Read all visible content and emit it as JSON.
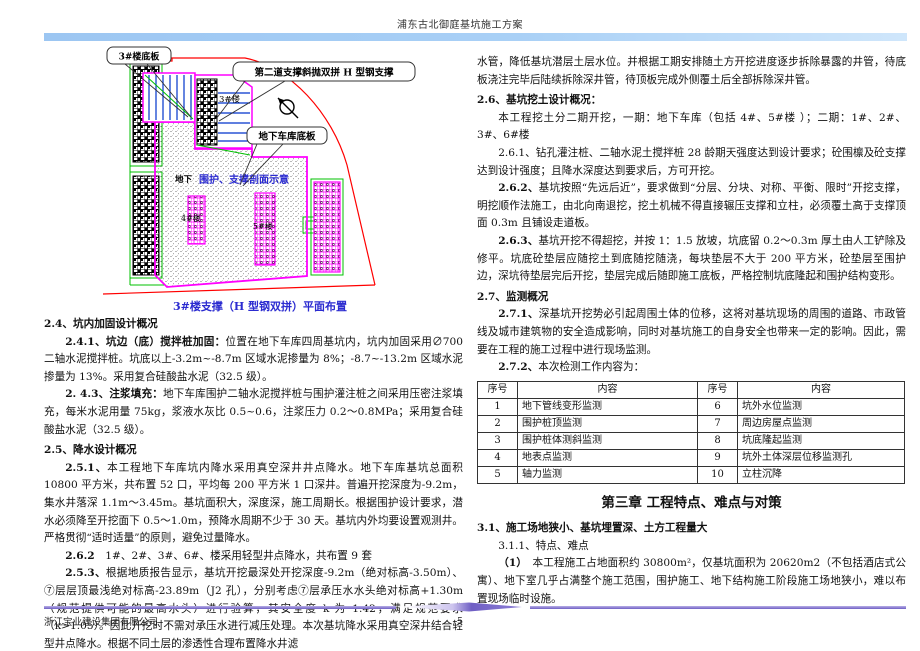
{
  "header": {
    "title": "浦东古北御庭基坑施工方案"
  },
  "diagram": {
    "callout_slab3": "3#楼底板",
    "callout_brace": "第二道支撑斜抛双拼 H 型钢支撑",
    "callout_garage": "地下车库底板",
    "label_underground": "地下",
    "label_section_sketch": "围护、支撑剖面示意",
    "label_bldg3": "3#楼",
    "label_bldg4": "4#楼",
    "label_bldg5": "5#楼",
    "caption": "3#楼支撑（H 型钢双拼）平面布置",
    "colors": {
      "boundary_red": "#ff0000",
      "pit_magenta": "#ff00ff",
      "site_green": "#00c000",
      "brace_blue": "#0033cc",
      "caption_blue": "#2b2bd0"
    }
  },
  "left": {
    "s24_title": "2.4、坑内加固设计概况",
    "s241_label": "2.4.1、坑边（底）搅拌桩加固：",
    "s241_text": "位置在地下车库四周基坑内，坑内加固采用∅700 二轴水泥搅拌桩。坑底以上-3.2m~-8.7m 区域水泥掺量为 8%；-8.7~-13.2m 区域水泥掺量为 13%。采用复合硅酸盐水泥（32.5 级）。",
    "s243_label": "2. 4.3、注浆填充：",
    "s243_text": "地下车库围护二轴水泥搅拌桩与围护灌注桩之间采用压密注浆填充，每米水泥用量 75kg，浆液水灰比 0.5~0.6，注浆压力 0.2～0.8MPa；采用复合硅酸盐水泥（32.5 级）。",
    "s25_title": "2.5、降水设计概况",
    "s251_label": "2.5.1、",
    "s251_text": "本工程地下车库坑内降水采用真空深井井点降水。地下车库基坑总面积 10800 平方米，共布置 52 口，平均每 200 平方米 1 口深井。普遍开挖深度为-9.2m，集水井落深 1.1m～3.45m。基坑面积大，深度深，施工周期长。根据围护设计要求，潜水必须降至开挖面下 0.5～1.0m，预降水周期不少于 30 天。基坑内外均要设置观测井。严格贯彻“适时适量”的原则，避免过量降水。",
    "s262_label": "2.6.2",
    "s262_text": "　1#、2#、3#、6#、楼采用轻型井点降水，共布置 9 套",
    "s253_label": "2.5.3、",
    "s253_text": "根据地质报告显示，基坑开挖最深处开挖深度-9.2m（绝对标高-3.50m）、⑦层层顶最浅绝对标高-23.89m（J2 孔），分别考虑⑦层承压水水头绝对标高+1.30m（规范提供可能的最高水头）进行验算，其安全度 k 为 1.42，满足规范要求（k>1.05）。因此开挖时不需对承压水进行减压处理。本次基坑降水采用真空深井结合轻型井点降水。根据不同土层的渗透性合理布置降水井滤"
  },
  "right": {
    "cont_text": "水管，降低基坑潜层土层水位。并根据工期安排随土方开挖进度逐步拆除暴露的井管，待底板浇注完毕后陆续拆除深井管，待顶板完成外侧覆土后全部拆除深井管。",
    "s26_title": "2.6、基坑挖土设计概况：",
    "s26_intro": "本工程挖土分二期开挖，一期：地下车库（包括 4#、5#楼 ）；二期：1#、2#、3#、6#楼",
    "s261_label": "2.6.1、",
    "s261_text": "钻孔灌注桩、二轴水泥土搅拌桩 28 龄期天强度达到设计要求；砼围檩及砼支撑达到设计强度；且降水深度达到要求后，方可开挖。",
    "s262_label": "2.6.2、",
    "s262_text": "基坑按照“先远后近”，要求做到“分层、分块、对称、平衡、限时”开挖支撑，明挖顺作法施工，由北向南退挖，挖土机械不得直接辗压支撑和立柱，必须覆土高于支撑顶面 0.3m 且铺设走道板。",
    "s263_label": "2.6.3、",
    "s263_text": "基坑开挖不得超挖，并按 1：1.5 放坡，坑底留 0.2～0.3m 厚土由人工铲除及修平。坑底砼垫层应随挖土到底随挖随浇，每块垫层不大于 200 平方米，砼垫层至围护边，深坑待垫层完后开挖，垫层完成后随即施工底板，严格控制坑底隆起和围护结构变形。",
    "s27_title": "2.7、监测概况",
    "s271_label": "2.7.1、",
    "s271_text": "深基坑开挖势必引起周围土体的位移，这将对基坑现场的周围的道路、市政管线及城市建筑物的安全造成影响，同时对基坑施工的自身安全也带来一定的影响。因此，需要在工程的施工过程中进行现场监测。",
    "s272_label": "2.7.2、",
    "s272_text": "本次检测工作内容为：",
    "table": {
      "headers": [
        "序号",
        "内容",
        "序号",
        "内容"
      ],
      "rows": [
        [
          "1",
          "地下管线变形监测",
          "6",
          "坑外水位监测"
        ],
        [
          "2",
          "围护桩顶监测",
          "7",
          "周边房屋点监测"
        ],
        [
          "3",
          "围护桩体测斜监测",
          "8",
          "坑底隆起监测"
        ],
        [
          "4",
          "地表点监测",
          "9",
          "坑外土体深层位移监测孔"
        ],
        [
          "5",
          "轴力监测",
          "10",
          "立柱沉降"
        ]
      ]
    },
    "ch3_title": "第三章 工程特点、难点与对策",
    "s31_title": "3.1、施工场地狭小、基坑埋置深、土方工程量大",
    "s311_title": "3.1.1、特点、难点",
    "p1_label": "（1）",
    "p1_text": "　本工程施工占地面积约 30800m²，仅基坑面积为 20620m2（不包括酒店式公寓）、地下室几乎占满整个施工范围，围护施工、地下结构施工阶段施工场地狭小，难以布置现场临时设施。"
  },
  "footer": {
    "company": "浙江宝业建设集团有限公司",
    "page": "5"
  }
}
